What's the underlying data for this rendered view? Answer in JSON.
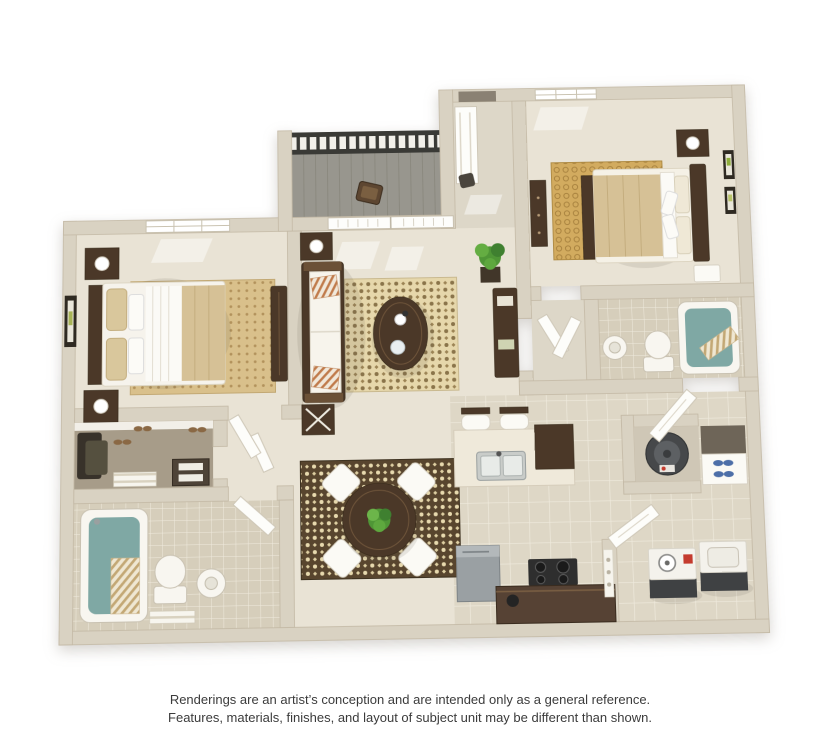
{
  "page": {
    "background": "#ffffff",
    "disclaimer_line1": "Renderings are an artist’s conception and are intended only as a general reference.",
    "disclaimer_line2": "Features, materials, finishes, and layout of subject unit may be different than shown."
  },
  "floorplan": {
    "style": "3d-rendered-apartment-floor-plan",
    "rooms": [
      {
        "name": "balcony",
        "features": [
          "metal-railing",
          "plank-deck",
          "patio-chair"
        ]
      },
      {
        "name": "entry-hall",
        "features": [
          "front-door-opening",
          "open-door-panel",
          "door-handle"
        ]
      },
      {
        "name": "bedroom-2",
        "features": [
          "bed",
          "headboard",
          "nightstand",
          "lamp",
          "dresser",
          "bench",
          "honeycomb-rug",
          "wall-art-frames",
          "window"
        ]
      },
      {
        "name": "bathroom-2",
        "features": [
          "bathtub",
          "striped-towel",
          "toilet",
          "pedestal-sink",
          "double-doors"
        ]
      },
      {
        "name": "bedroom-1",
        "features": [
          "bed",
          "headboard",
          "two-nightstands",
          "lamps",
          "armoire",
          "dotted-rug",
          "wall-art-frame",
          "window"
        ]
      },
      {
        "name": "living-room",
        "features": [
          "sofa",
          "striped-pillows",
          "oval-coffee-table",
          "damask-rug",
          "end-tables",
          "console-table",
          "potted-plant",
          "french-doors-with-blinds",
          "wall-art-frame"
        ]
      },
      {
        "name": "dining-area",
        "features": [
          "round-table",
          "four-white-chairs",
          "centerpiece-plant",
          "damask-rug"
        ]
      },
      {
        "name": "kitchen",
        "features": [
          "breakfast-bar",
          "two-bar-stools",
          "double-sink",
          "refrigerator",
          "cooktop",
          "lower-counter",
          "kettle"
        ]
      },
      {
        "name": "walk-in-closet",
        "features": [
          "hanging-clothes",
          "white-shelf",
          "shoe-pairs",
          "striped-mat",
          "drawer-unit"
        ]
      },
      {
        "name": "bathroom-1",
        "features": [
          "bathtub",
          "striped-shower-curtain",
          "toilet",
          "pedestal-sink",
          "bath-mat"
        ]
      },
      {
        "name": "utility-closet",
        "features": [
          "water-heater",
          "shoe-shelf",
          "open-door"
        ]
      },
      {
        "name": "laundry-closet",
        "features": [
          "washer",
          "dryer",
          "open-door",
          "door-trim"
        ]
      }
    ],
    "colors": {
      "wall": "#d9d2c2",
      "wall_edge": "#c3b9a5",
      "carpet": "#e9e3d5",
      "carpet_hall": "#ddd7c8",
      "tile": "#ded7c6",
      "tile_dark": "#d6cebb",
      "grout": "#efeadd",
      "wood": "#4b3828",
      "wood_light": "#6b5137",
      "rug_gold": "#d2ab5f",
      "rug_tan": "#d9c08b",
      "rug_cream": "#e6d7ab",
      "rug_brown": "#58452e",
      "deck": "#98968e",
      "railing": "#3a3a36",
      "water": "#7fa8a4",
      "plant": "#5ea83e",
      "appliance": "#9aa0a3",
      "appliance_dark": "#46484a",
      "accent_red": "#c43b2e",
      "shoe_blue": "#4d6fa8",
      "text": "#3b3b3b"
    }
  }
}
